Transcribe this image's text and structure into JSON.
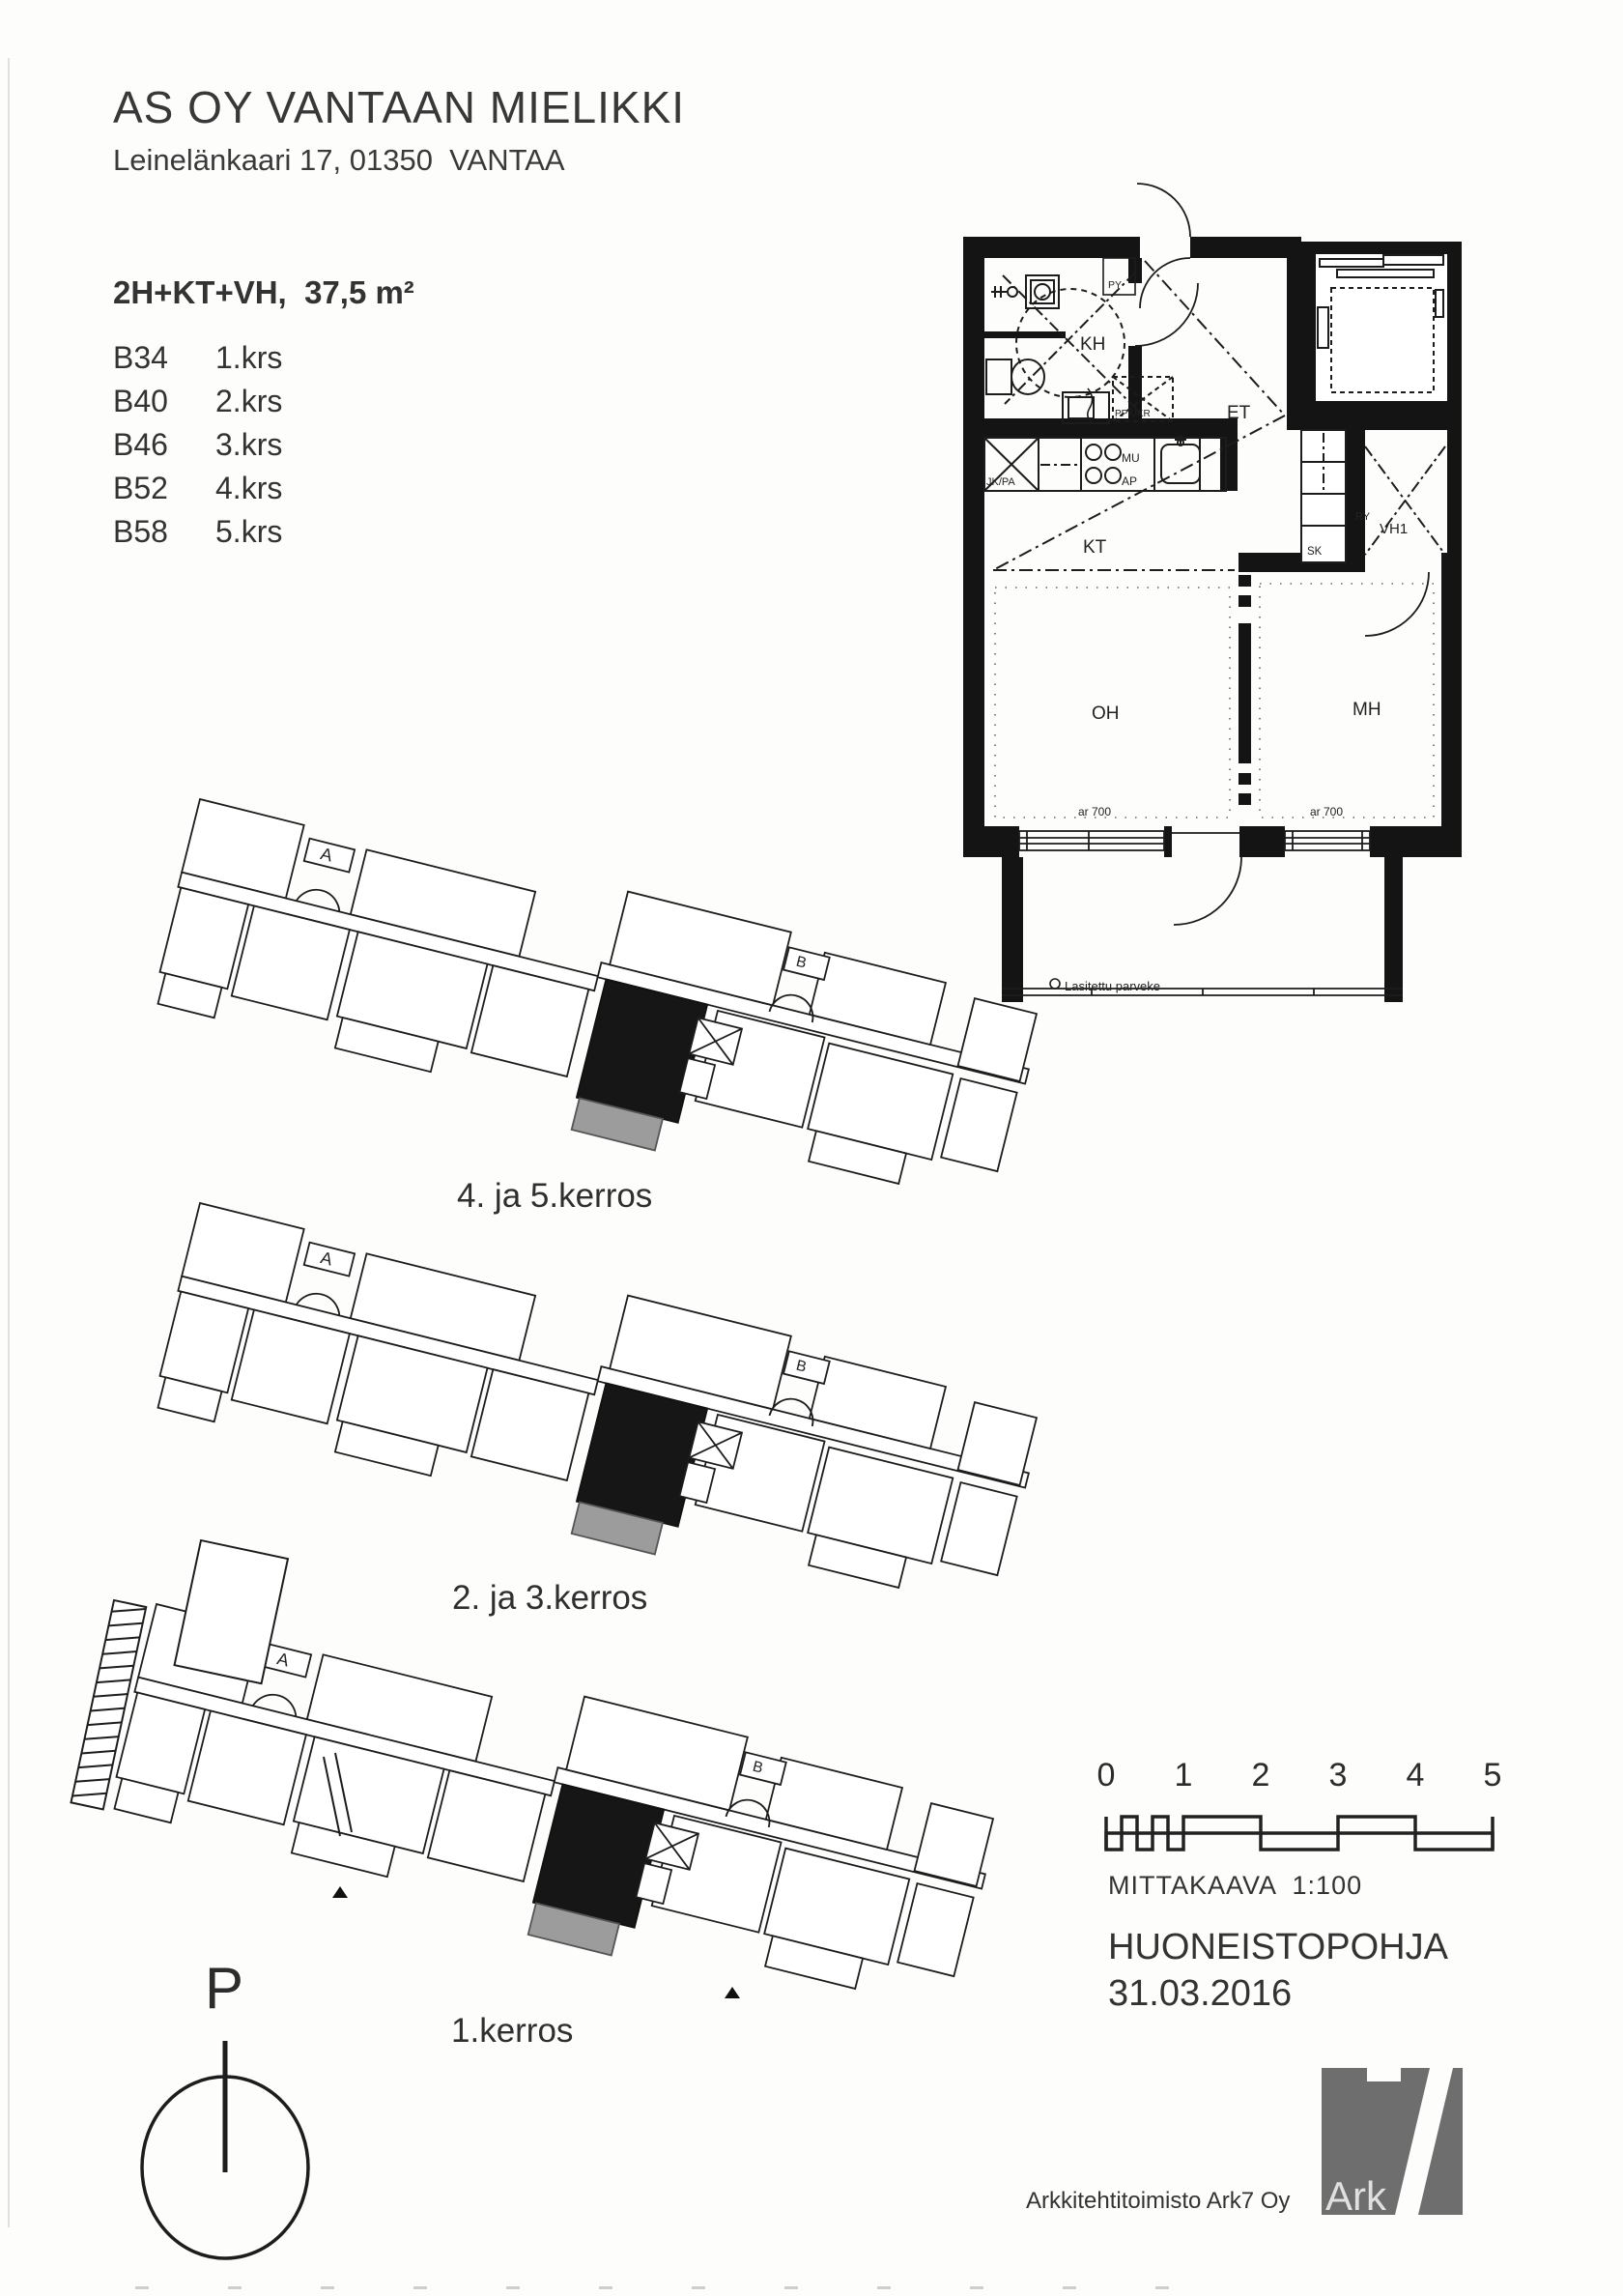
{
  "header": {
    "title": "AS OY VANTAAN MIELIKKI",
    "address": "Leinelänkaari 17, 01350  VANTAA"
  },
  "apartment": {
    "type_area": "2H+KT+VH,  37,5 m²",
    "units": [
      {
        "id": "B34",
        "floor": "1.krs"
      },
      {
        "id": "B40",
        "floor": "2.krs"
      },
      {
        "id": "B46",
        "floor": "3.krs"
      },
      {
        "id": "B52",
        "floor": "4.krs"
      },
      {
        "id": "B58",
        "floor": "5.krs"
      }
    ]
  },
  "floor_plan": {
    "rooms": {
      "kh": "KH",
      "et": "ET",
      "kt": "KT",
      "oh": "OH",
      "mh": "MH",
      "vh1": "VH1"
    },
    "closets": {
      "sk": "SK",
      "ry": "RY",
      "py": "PY"
    },
    "fixtures": {
      "fridge": "JK/PA",
      "stove": "MU",
      "counter": "AP",
      "dishwasher": "PPK/KR"
    },
    "window_notes": [
      "ar 700",
      "ar 700"
    ],
    "balcony_label": "Lasitettu parveke"
  },
  "site_plans": [
    {
      "label": "4. ja 5.kerros"
    },
    {
      "label": "2. ja 3.kerros"
    },
    {
      "label": "1.kerros"
    }
  ],
  "stairwells": {
    "a": "A",
    "b": "B"
  },
  "compass": {
    "label": "P"
  },
  "scale_bar": {
    "ticks": [
      "0",
      "1",
      "2",
      "3",
      "4",
      "5"
    ],
    "caption": "MITTAKAAVA  1:100"
  },
  "footer": {
    "drawing_type": "HUONEISTOPOHJA",
    "date": "31.03.2016",
    "firm": "Arkkitehtitoimisto Ark7 Oy",
    "logo_text": "Ark"
  },
  "colors": {
    "line": "#1d1d1d",
    "highlight_unit": "#161616",
    "balcony_gray": "#9c9c9c",
    "logo_gray": "#6e6e6e"
  }
}
